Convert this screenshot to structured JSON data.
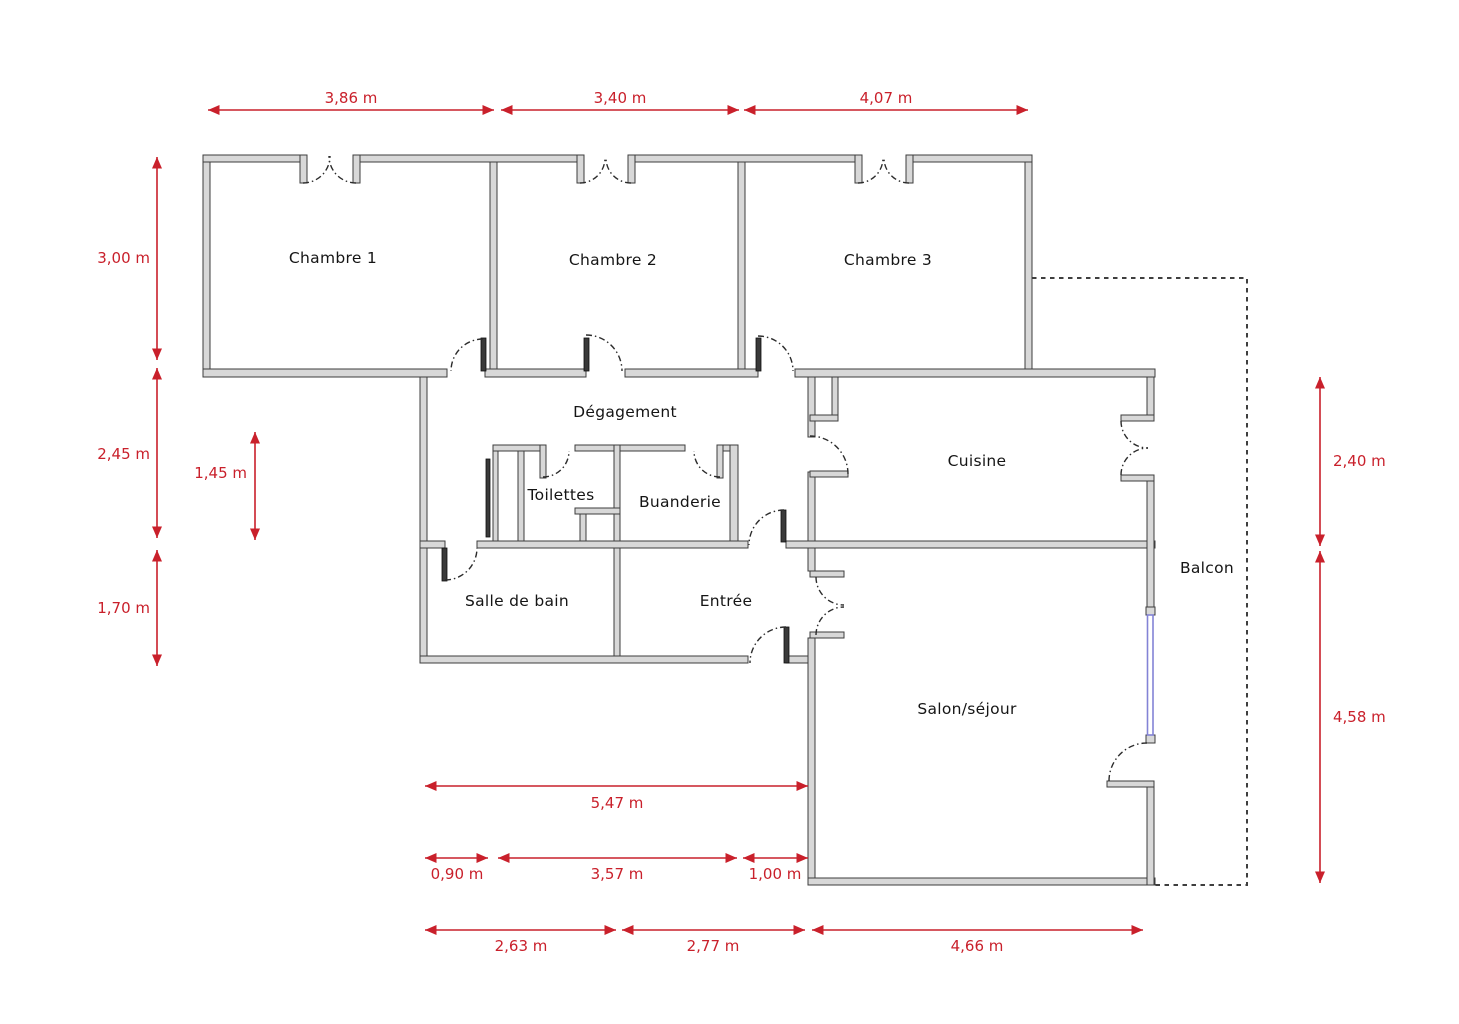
{
  "diagram": {
    "type": "floor_plan",
    "description": "Apartment floor plan with labelled rooms, door swings, a balcony and red dimension arrows in metres"
  },
  "colors": {
    "background": "#ffffff",
    "wall_fill": "#d8d8d8",
    "wall_stroke": "#3d3d3d",
    "door_leaf": "#3a3a3a",
    "dimension_red": "#c9202b",
    "window_blue": "#8383d6",
    "balcony_dash": "#3f3f3f",
    "label_text": "#151515"
  },
  "rooms": {
    "chambre1": {
      "label": "Chambre 1"
    },
    "chambre2": {
      "label": "Chambre 2"
    },
    "chambre3": {
      "label": "Chambre 3"
    },
    "degagement": {
      "label": "Dégagement"
    },
    "toilettes": {
      "label": "Toilettes"
    },
    "buanderie": {
      "label": "Buanderie"
    },
    "cuisine": {
      "label": "Cuisine"
    },
    "salle_de_bain": {
      "label": "Salle de bain"
    },
    "entree": {
      "label": "Entrée"
    },
    "salon": {
      "label": "Salon/séjour"
    },
    "balcon": {
      "label": "Balcon"
    }
  },
  "dimensions": {
    "top": [
      {
        "label": "3,86 m",
        "meters": 3.86
      },
      {
        "label": "3,40 m",
        "meters": 3.4
      },
      {
        "label": "4,07 m",
        "meters": 4.07
      }
    ],
    "left": [
      {
        "label": "3,00 m",
        "meters": 3.0
      },
      {
        "label": "2,45 m",
        "meters": 2.45
      },
      {
        "label": "1,70 m",
        "meters": 1.7
      },
      {
        "label": "1,45 m",
        "meters": 1.45
      }
    ],
    "right": [
      {
        "label": "2,40 m",
        "meters": 2.4
      },
      {
        "label": "4,58 m",
        "meters": 4.58
      }
    ],
    "bottom": [
      {
        "label": "5,47 m",
        "meters": 5.47
      },
      {
        "label": "0,90 m",
        "meters": 0.9
      },
      {
        "label": "3,57 m",
        "meters": 3.57
      },
      {
        "label": "1,00 m",
        "meters": 1.0
      },
      {
        "label": "2,63 m",
        "meters": 2.63
      },
      {
        "label": "2,77 m",
        "meters": 2.77
      },
      {
        "label": "4,66 m",
        "meters": 4.66
      }
    ]
  }
}
